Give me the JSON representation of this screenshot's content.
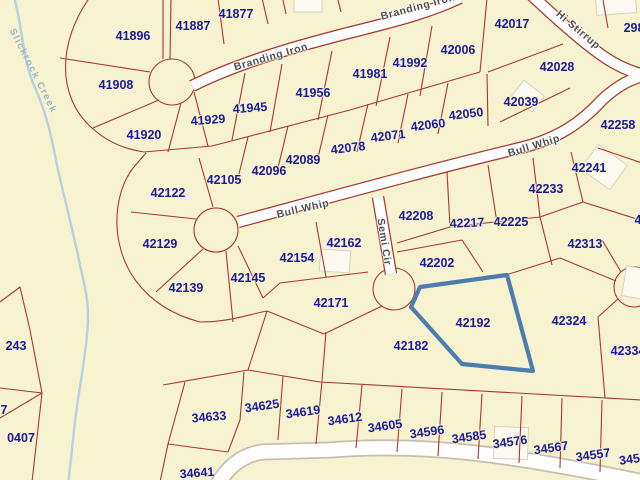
{
  "map": {
    "background_color": "#f7f3d1",
    "parcel_line_color": "#a8382e",
    "parcel_label_color": "#1b1b99",
    "street_label_color": "#4f4f4f",
    "road_fill_color": "#ffffff",
    "creek_color": "#b9cfdf",
    "creek_label_color": "#93b7cd",
    "highlight_color": "#4d7cae",
    "creek_label": {
      "text": "Slickrock Creek"
    },
    "streets": [
      {
        "name": "Branding Iron",
        "x": 271,
        "y": 57,
        "rot": -16
      },
      {
        "name": "Branding Iron",
        "x": 418,
        "y": 7,
        "rot": -15
      },
      {
        "name": "Hi Stirrup",
        "x": 578,
        "y": 30,
        "rot": 40
      },
      {
        "name": "Bull Whip",
        "x": 303,
        "y": 209,
        "rot": -13
      },
      {
        "name": "Bull Whip",
        "x": 534,
        "y": 146,
        "rot": -17
      },
      {
        "name": "Semi Cir",
        "x": 384,
        "y": 242,
        "rot": 81
      }
    ],
    "highlighted_parcel": {
      "id": "42192",
      "points": "420,287 507,275 533,371 462,364 411,307"
    },
    "parcels": [
      {
        "label": "41877",
        "x": 236,
        "y": 14,
        "rot": 0
      },
      {
        "label": "41887",
        "x": 193,
        "y": 26,
        "rot": 0
      },
      {
        "label": "41896",
        "x": 133,
        "y": 36,
        "rot": 0
      },
      {
        "label": "41908",
        "x": 116,
        "y": 85,
        "rot": 0
      },
      {
        "label": "41920",
        "x": 144,
        "y": 135,
        "rot": 0
      },
      {
        "label": "41929",
        "x": 208,
        "y": 120,
        "rot": -4
      },
      {
        "label": "41945",
        "x": 250,
        "y": 108,
        "rot": -4
      },
      {
        "label": "41956",
        "x": 313,
        "y": 93,
        "rot": 0
      },
      {
        "label": "41981",
        "x": 370,
        "y": 74,
        "rot": 0
      },
      {
        "label": "41992",
        "x": 410,
        "y": 63,
        "rot": 0
      },
      {
        "label": "42006",
        "x": 458,
        "y": 50,
        "rot": 0
      },
      {
        "label": "42017",
        "x": 512,
        "y": 24,
        "rot": 0
      },
      {
        "label": "42028",
        "x": 557,
        "y": 67,
        "rot": 0
      },
      {
        "label": "42039",
        "x": 521,
        "y": 102,
        "rot": 0
      },
      {
        "label": "42050",
        "x": 466,
        "y": 114,
        "rot": -7
      },
      {
        "label": "42060",
        "x": 428,
        "y": 125,
        "rot": -7
      },
      {
        "label": "42071",
        "x": 388,
        "y": 136,
        "rot": -7
      },
      {
        "label": "42078",
        "x": 348,
        "y": 148,
        "rot": -7
      },
      {
        "label": "42089",
        "x": 303,
        "y": 160,
        "rot": 0
      },
      {
        "label": "42096",
        "x": 269,
        "y": 171,
        "rot": 0
      },
      {
        "label": "42105",
        "x": 224,
        "y": 180,
        "rot": 0
      },
      {
        "label": "42122",
        "x": 168,
        "y": 193,
        "rot": 0
      },
      {
        "label": "42129",
        "x": 160,
        "y": 244,
        "rot": 0
      },
      {
        "label": "42139",
        "x": 186,
        "y": 288,
        "rot": 0
      },
      {
        "label": "42145",
        "x": 248,
        "y": 278,
        "rot": 0
      },
      {
        "label": "42154",
        "x": 297,
        "y": 258,
        "rot": 0
      },
      {
        "label": "42162",
        "x": 344,
        "y": 243,
        "rot": 0
      },
      {
        "label": "42171",
        "x": 331,
        "y": 303,
        "rot": 0
      },
      {
        "label": "42182",
        "x": 411,
        "y": 346,
        "rot": 0
      },
      {
        "label": "42192",
        "x": 473,
        "y": 323,
        "rot": 0
      },
      {
        "label": "42202",
        "x": 437,
        "y": 263,
        "rot": 0
      },
      {
        "label": "42208",
        "x": 416,
        "y": 216,
        "rot": 0
      },
      {
        "label": "42217",
        "x": 467,
        "y": 223,
        "rot": -3
      },
      {
        "label": "42225",
        "x": 511,
        "y": 222,
        "rot": 0
      },
      {
        "label": "42233",
        "x": 546,
        "y": 189,
        "rot": 0
      },
      {
        "label": "42241",
        "x": 589,
        "y": 168,
        "rot": 0
      },
      {
        "label": "42258",
        "x": 618,
        "y": 125,
        "rot": 0
      },
      {
        "label": "42313",
        "x": 585,
        "y": 244,
        "rot": 0
      },
      {
        "label": "42324",
        "x": 569,
        "y": 321,
        "rot": 0
      },
      {
        "label": "42334",
        "x": 628,
        "y": 351,
        "rot": 0
      },
      {
        "label": "298",
        "x": 634,
        "y": 28,
        "rot": 0
      },
      {
        "label": "4",
        "x": 638,
        "y": 220,
        "rot": 0
      },
      {
        "label": "243",
        "x": 16,
        "y": 346,
        "rot": 0
      },
      {
        "label": "7",
        "x": 4,
        "y": 410,
        "rot": 0
      },
      {
        "label": "0407",
        "x": 21,
        "y": 438,
        "rot": 0
      },
      {
        "label": "34641",
        "x": 197,
        "y": 473,
        "rot": -4
      },
      {
        "label": "34633",
        "x": 209,
        "y": 417,
        "rot": -5
      },
      {
        "label": "34625",
        "x": 262,
        "y": 406,
        "rot": -8
      },
      {
        "label": "34619",
        "x": 303,
        "y": 412,
        "rot": -8
      },
      {
        "label": "34612",
        "x": 345,
        "y": 419,
        "rot": -8
      },
      {
        "label": "34605",
        "x": 385,
        "y": 426,
        "rot": -8
      },
      {
        "label": "34596",
        "x": 427,
        "y": 432,
        "rot": -8
      },
      {
        "label": "34585",
        "x": 469,
        "y": 437,
        "rot": -8
      },
      {
        "label": "34576",
        "x": 510,
        "y": 442,
        "rot": -8
      },
      {
        "label": "34567",
        "x": 551,
        "y": 448,
        "rot": -8
      },
      {
        "label": "34557",
        "x": 593,
        "y": 455,
        "rot": -8
      },
      {
        "label": "3454",
        "x": 633,
        "y": 459,
        "rot": -8
      }
    ]
  }
}
